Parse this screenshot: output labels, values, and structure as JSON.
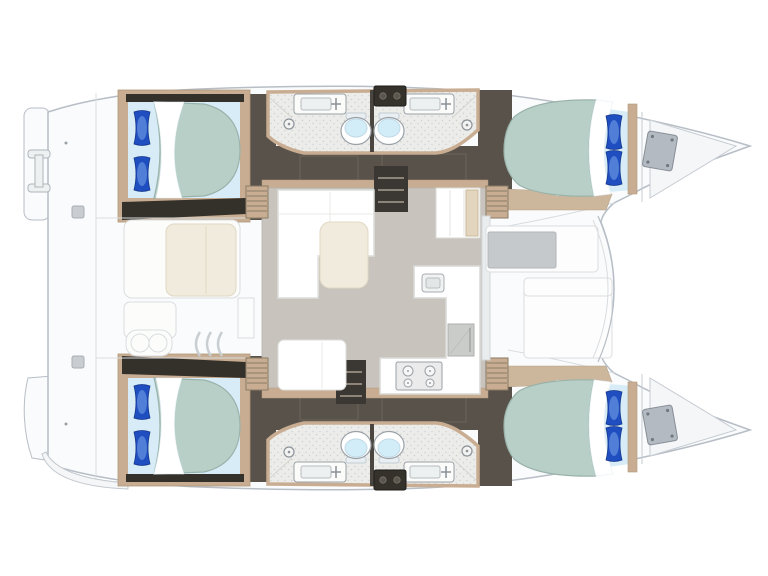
{
  "colors": {
    "background": "#ffffff",
    "hullFill": "#fafbfc",
    "hullStroke": "#b7bec6",
    "deckLine": "#d9dde0",
    "darkFloor": "#59524a",
    "darkFloorPanel": "#6b645b",
    "darkBand": "#34302a",
    "stairDark": "#3b3733",
    "stairTread": "#8d857a",
    "woodTrim": "#c8ad92",
    "woodLight": "#e2d4bd",
    "woodFloor": "#cdb79c",
    "saloonFloor": "#c8c4bd",
    "bathFloor": "#ececea",
    "speckle": "#d0d0ca",
    "bedSheet": "#d7ecf7",
    "mattress": "#b8cfc7",
    "mattressEdge": "#9ab3aa",
    "pillowDark": "#1f4ec0",
    "pillowLight": "#7aa6ea",
    "white": "#ffffff",
    "cream": "#f1ebdd",
    "creamEdge": "#e0d8c4",
    "hatchGray": "#b4bac1",
    "hatchEdge": "#878e95",
    "toiletBlue": "#d3edf8",
    "fixtureEdge": "#9aa1a7",
    "seatGray": "#c6c9cb",
    "applianceGray": "#c9ccc9"
  },
  "floorplan": {
    "type": "sailing-catamaran-deck-plan",
    "layout": "4-cabins-4-bathrooms",
    "orientation": {
      "bow": "right",
      "stern": "left"
    },
    "hulls": [
      {
        "name": "port-hull",
        "position": "top",
        "rooms": [
          "aft-double-cabin",
          "aft-bathroom",
          "forward-bathroom",
          "forward-double-cabin",
          "bow-locker"
        ]
      },
      {
        "name": "starboard-hull",
        "position": "bottom",
        "rooms": [
          "aft-double-cabin",
          "aft-bathroom",
          "forward-bathroom",
          "forward-double-cabin",
          "bow-locker"
        ]
      }
    ],
    "cabin_fixtures": [
      "double-berth",
      "sage-mattress",
      "folded-white-sheet",
      "two-blue-pillows",
      "wood-cabin-sole"
    ],
    "bathroom_fixtures": [
      "washbasin-with-faucet",
      "toilet",
      "shower-drain",
      "dark-deck-hatch"
    ],
    "saloon": {
      "furniture": [
        "l-shaped-sofa",
        "coffee-table",
        "aft-bench",
        "galley-l-counter",
        "galley-sink",
        "four-burner-stove",
        "top-loading-fridge",
        "forward-cabinet",
        "port-companionway-stairs",
        "starboard-companionway-stairs",
        "corner-step-lockers"
      ]
    },
    "cockpit": {
      "furniture": [
        "bench-seat",
        "cream-seat-cushion",
        "side-bench",
        "helm-double-seat",
        "engine-vent-louvres"
      ]
    },
    "foredeck": {
      "furniture": [
        "forward-cockpit-recess",
        "gray-seat-pad",
        "sun-pad"
      ]
    },
    "stern": {
      "features": [
        "port-transom-wing",
        "boarding-ladder",
        "starboard-transom-wing",
        "swim-step",
        "cleats"
      ]
    }
  }
}
